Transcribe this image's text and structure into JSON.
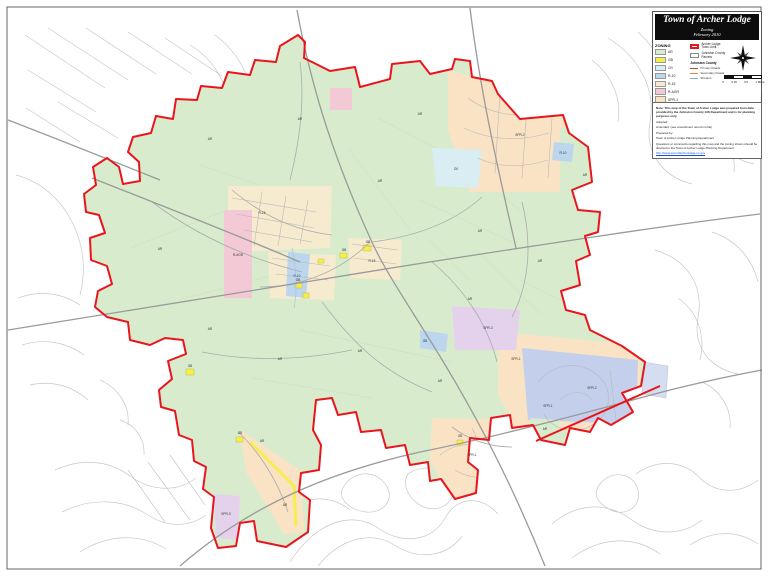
{
  "title_block": {
    "title": "Town of Archer Lodge",
    "subtitle": "Zoning",
    "date": "February 2010"
  },
  "legend": {
    "heading": "ZONING",
    "items": [
      {
        "code": "AR"
      },
      {
        "code": "GB"
      },
      {
        "code": "O/I"
      },
      {
        "code": "R-10"
      },
      {
        "code": "R-15"
      },
      {
        "code": "R-AGR"
      },
      {
        "code": "SPR-1"
      },
      {
        "code": "SPR-2"
      },
      {
        "code": "SPR-3"
      }
    ],
    "boundaries": [
      {
        "label": "Archer Lodge Town Limit",
        "color": "#e8151c",
        "width": 2
      },
      {
        "label": "Johnston County Parcels",
        "color": "#888888",
        "width": 1
      }
    ],
    "sub_heading": "Johnston County",
    "sub_items": [
      {
        "label": "Primary Roads",
        "color": "#cc4444"
      },
      {
        "label": "Secondary Roads",
        "color": "#dd8833"
      },
      {
        "label": "Streams",
        "color": "#88aacc"
      }
    ]
  },
  "scale": {
    "labels": [
      "0",
      "0.25",
      "0.5",
      "1 Miles"
    ]
  },
  "notes": {
    "lines": [
      "Note: This map of the Town of Archer Lodge was prepared from data provided by the Johnston County GIS Department and is for planning purposes only.",
      "Adopted:",
      "Amended: (see amendment record on file)",
      "Prepared by:",
      "Town of Archer Lodge Planning Department",
      "Questions or comments regarding this map and the zoning shown should be directed to the Town of Archer Lodge Planning Department:"
    ],
    "url": "http://www.townofarcherlodge-nc.gov"
  },
  "map": {
    "boundary_color": "#e8151c",
    "zone_colors": {
      "AR": "#d8eccd",
      "GB": "#f6ee4f",
      "O/I": "#d8eef2",
      "R-10": "#bcd6ee",
      "R-15": "#f7ebcf",
      "R-AGR": "#f4c9d6",
      "SPR-1": "#fae3c4",
      "SPR-2": "#c4cfec",
      "SPR-3": "#e4d2ec"
    },
    "labels": [
      {
        "t": "AR",
        "x": 210,
        "y": 140
      },
      {
        "t": "AR",
        "x": 300,
        "y": 120
      },
      {
        "t": "AR",
        "x": 420,
        "y": 115
      },
      {
        "t": "AR",
        "x": 380,
        "y": 182
      },
      {
        "t": "AR",
        "x": 160,
        "y": 250
      },
      {
        "t": "AR",
        "x": 210,
        "y": 330
      },
      {
        "t": "AR",
        "x": 280,
        "y": 360
      },
      {
        "t": "AR",
        "x": 360,
        "y": 352
      },
      {
        "t": "AR",
        "x": 440,
        "y": 382
      },
      {
        "t": "AR",
        "x": 480,
        "y": 232
      },
      {
        "t": "AR",
        "x": 540,
        "y": 262
      },
      {
        "t": "AR",
        "x": 585,
        "y": 176
      },
      {
        "t": "AR",
        "x": 545,
        "y": 430
      },
      {
        "t": "AR",
        "x": 262,
        "y": 442
      },
      {
        "t": "AR",
        "x": 285,
        "y": 506
      },
      {
        "t": "AR",
        "x": 470,
        "y": 300
      },
      {
        "t": "R-AGR",
        "x": 238,
        "y": 256
      },
      {
        "t": "R-15",
        "x": 262,
        "y": 214
      },
      {
        "t": "R-15",
        "x": 372,
        "y": 262
      },
      {
        "t": "SPR-2",
        "x": 520,
        "y": 136
      },
      {
        "t": "SPR-2",
        "x": 592,
        "y": 389
      },
      {
        "t": "SPR-1",
        "x": 516,
        "y": 360
      },
      {
        "t": "SPR-1",
        "x": 548,
        "y": 407
      },
      {
        "t": "SPR-1",
        "x": 472,
        "y": 456
      },
      {
        "t": "SPR-3",
        "x": 488,
        "y": 329
      },
      {
        "t": "SPR-3",
        "x": 226,
        "y": 515
      },
      {
        "t": "O/I",
        "x": 456,
        "y": 170
      },
      {
        "t": "R-10",
        "x": 297,
        "y": 277
      },
      {
        "t": "R-10",
        "x": 563,
        "y": 154
      },
      {
        "t": "GB",
        "x": 368,
        "y": 243
      },
      {
        "t": "GB",
        "x": 344,
        "y": 251
      },
      {
        "t": "GB",
        "x": 298,
        "y": 281
      },
      {
        "t": "GB",
        "x": 190,
        "y": 367
      },
      {
        "t": "GB",
        "x": 240,
        "y": 434
      },
      {
        "t": "GB",
        "x": 425,
        "y": 342
      },
      {
        "t": "GB",
        "x": 460,
        "y": 437
      }
    ]
  }
}
